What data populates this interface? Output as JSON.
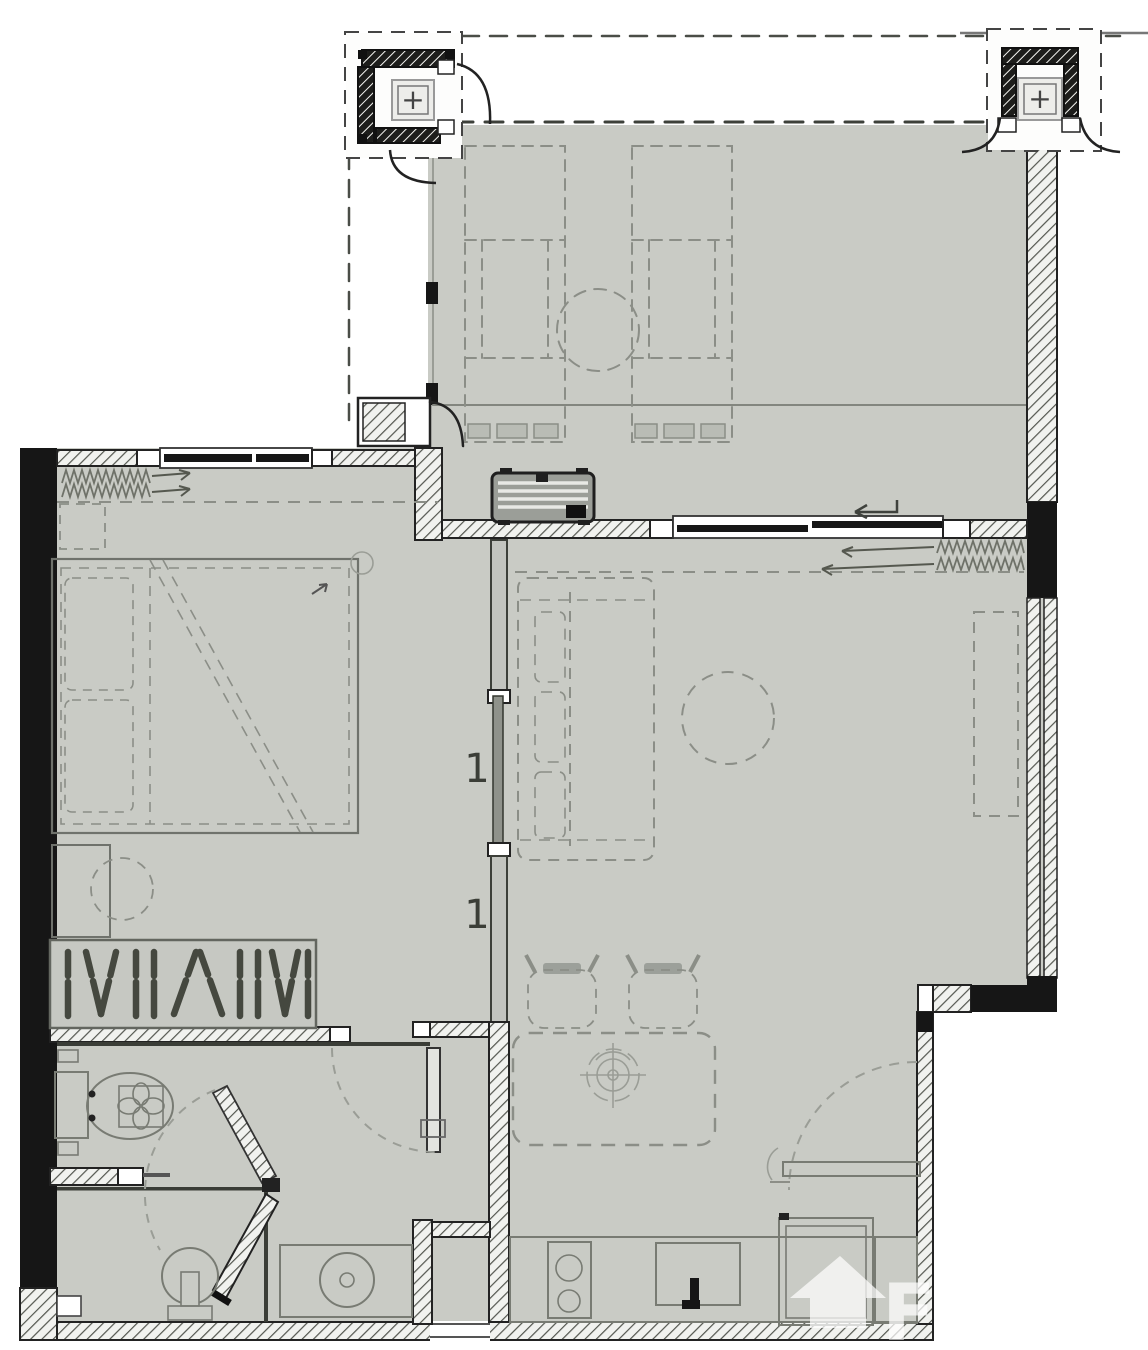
{
  "document": {
    "kind": "apartment floor plan drawing",
    "watermark_letter": "F"
  },
  "markers": {
    "column_symbol": "+",
    "sliding_door_label": "1"
  },
  "colors": {
    "background": "#ffffff",
    "floor": "#c9cbc5",
    "wall_dark": "#1a1a1a",
    "hatch_line": "#53564f",
    "furniture_line": "#787b73",
    "dashed_line": "#8b8e87",
    "watermark": "#ffffff"
  },
  "rooms": [
    {
      "name": "balcony-terrace"
    },
    {
      "name": "bedroom"
    },
    {
      "name": "living-dining-room"
    },
    {
      "name": "hallway"
    },
    {
      "name": "bathroom"
    },
    {
      "name": "kitchen"
    }
  ],
  "fixtures": [
    "sun-lounger",
    "sun-lounger",
    "round-side-table",
    "double-bed",
    "pillows",
    "bedside-stool",
    "wardrobe-with-hangers",
    "radiator",
    "radiator",
    "air-conditioner-unit",
    "sliding-door",
    "sofa",
    "coffee-table",
    "tv-cabinet",
    "dining-table",
    "dining-chair",
    "dining-chair",
    "centerpiece",
    "toilet",
    "pedestal-sink",
    "bath-door",
    "shower-screen",
    "washing-machine-counter",
    "kitchen-counter",
    "cooktop",
    "kitchen-sink",
    "refrigerator",
    "wall-shelf",
    "structural-column",
    "structural-column",
    "entry-threshold"
  ]
}
